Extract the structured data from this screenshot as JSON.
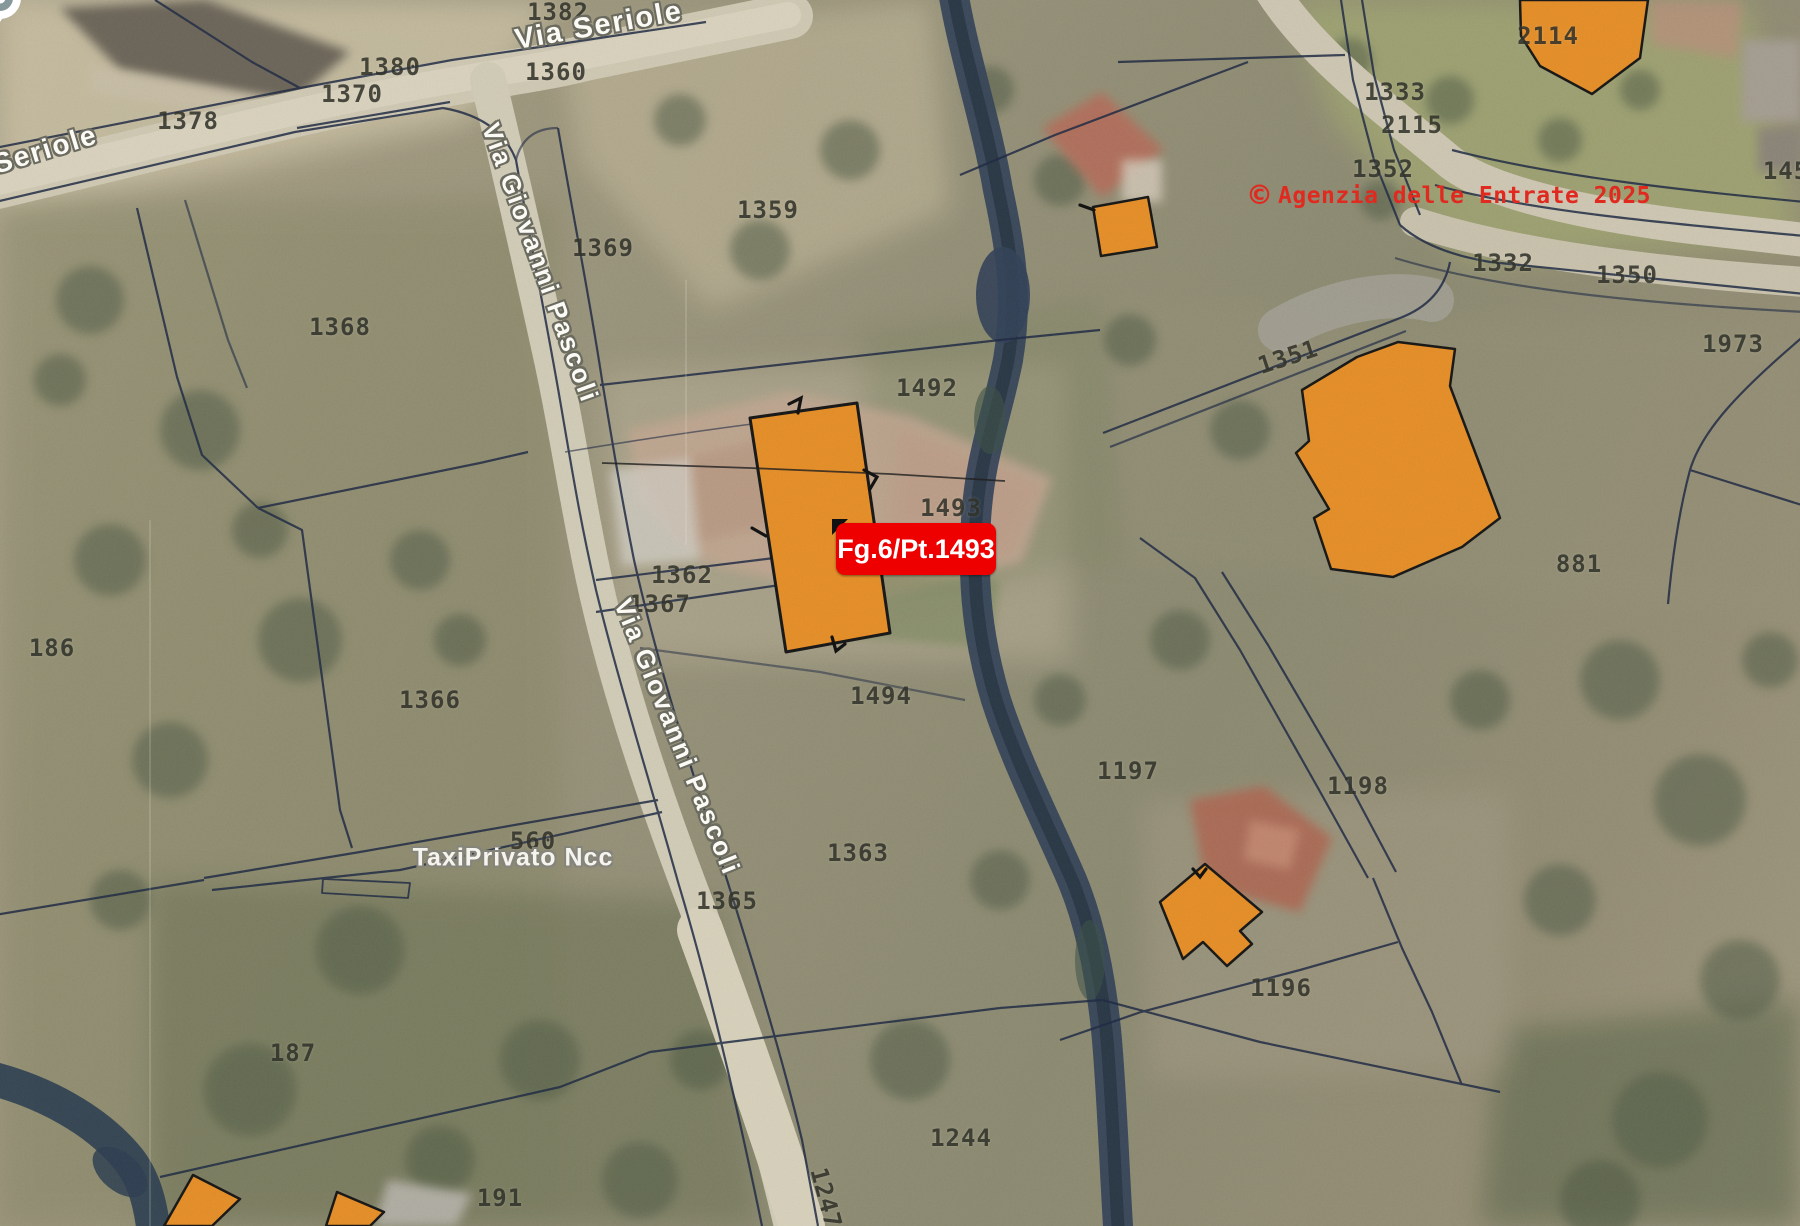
{
  "map": {
    "provider_watermark": {
      "copyright_symbol": "©",
      "text": "Agenzia delle Entrate 2025",
      "color": "#e02a20"
    },
    "highlight": {
      "label": "Fg.6/Pt.1493",
      "background": "#ee0000",
      "text_color": "#ffffff",
      "highlighted_parcel": "1493"
    },
    "poi": {
      "name": "TaxiPrivato Ncc",
      "marker": "white-dot-pin"
    },
    "streets": [
      {
        "id": "via-seriole-top",
        "name": "Via Seriole"
      },
      {
        "id": "via-seriole-left",
        "name": "Via Seriole"
      },
      {
        "id": "via-giovanni-pascoli-upper",
        "name": "Via Giovanni Pascoli"
      },
      {
        "id": "via-giovanni-pascoli-lower",
        "name": "Via Giovanni Pascoli"
      }
    ],
    "parcels": [
      {
        "number": "1382",
        "x": 558,
        "y": 12,
        "rotate": 0
      },
      {
        "number": "1380",
        "x": 390,
        "y": 67,
        "rotate": 0
      },
      {
        "number": "1370",
        "x": 352,
        "y": 94,
        "rotate": 0
      },
      {
        "number": "1378",
        "x": 188,
        "y": 121,
        "rotate": 0
      },
      {
        "number": "1360",
        "x": 556,
        "y": 72,
        "rotate": 0
      },
      {
        "number": "1369",
        "x": 603,
        "y": 248,
        "rotate": 0
      },
      {
        "number": "1368",
        "x": 340,
        "y": 327,
        "rotate": 0
      },
      {
        "number": "1359",
        "x": 768,
        "y": 210,
        "rotate": 0
      },
      {
        "number": "1492",
        "x": 927,
        "y": 388,
        "rotate": 0
      },
      {
        "number": "1493",
        "x": 951,
        "y": 508,
        "rotate": 0
      },
      {
        "number": "1362",
        "x": 682,
        "y": 575,
        "rotate": 0
      },
      {
        "number": "1367",
        "x": 660,
        "y": 604,
        "rotate": 0
      },
      {
        "number": "186",
        "x": 52,
        "y": 648,
        "rotate": 0
      },
      {
        "number": "1366",
        "x": 430,
        "y": 700,
        "rotate": 0
      },
      {
        "number": "1494",
        "x": 881,
        "y": 696,
        "rotate": 0
      },
      {
        "number": "1363",
        "x": 858,
        "y": 853,
        "rotate": 0
      },
      {
        "number": "560",
        "x": 533,
        "y": 841,
        "rotate": 0
      },
      {
        "number": "1365",
        "x": 727,
        "y": 901,
        "rotate": 0
      },
      {
        "number": "187",
        "x": 293,
        "y": 1053,
        "rotate": 0
      },
      {
        "number": "191",
        "x": 500,
        "y": 1198,
        "rotate": 0
      },
      {
        "number": "1244",
        "x": 961,
        "y": 1138,
        "rotate": 0
      },
      {
        "number": "1247",
        "x": 826,
        "y": 1198,
        "rotate": 75
      },
      {
        "number": "1197",
        "x": 1128,
        "y": 771,
        "rotate": 0
      },
      {
        "number": "1198",
        "x": 1358,
        "y": 786,
        "rotate": 0
      },
      {
        "number": "1196",
        "x": 1281,
        "y": 988,
        "rotate": 0
      },
      {
        "number": "2114",
        "x": 1548,
        "y": 36,
        "rotate": 0
      },
      {
        "number": "1333",
        "x": 1395,
        "y": 92,
        "rotate": 0
      },
      {
        "number": "2115",
        "x": 1412,
        "y": 125,
        "rotate": 0
      },
      {
        "number": "1352",
        "x": 1383,
        "y": 169,
        "rotate": 0
      },
      {
        "number": "1332",
        "x": 1503,
        "y": 263,
        "rotate": 0
      },
      {
        "number": "1350",
        "x": 1627,
        "y": 275,
        "rotate": 0
      },
      {
        "number": "1973",
        "x": 1733,
        "y": 344,
        "rotate": 0
      },
      {
        "number": "1351",
        "x": 1288,
        "y": 357,
        "rotate": -18
      },
      {
        "number": "881",
        "x": 1579,
        "y": 564,
        "rotate": 0
      },
      {
        "number": "145",
        "x": 1786,
        "y": 171,
        "rotate": 0
      }
    ],
    "colors": {
      "building_fill": "#ed9227",
      "parcel_line": "#1e2a45",
      "stream": "#33435a",
      "road": "#d6cfba",
      "parcel_number_text": "#33342c"
    }
  }
}
